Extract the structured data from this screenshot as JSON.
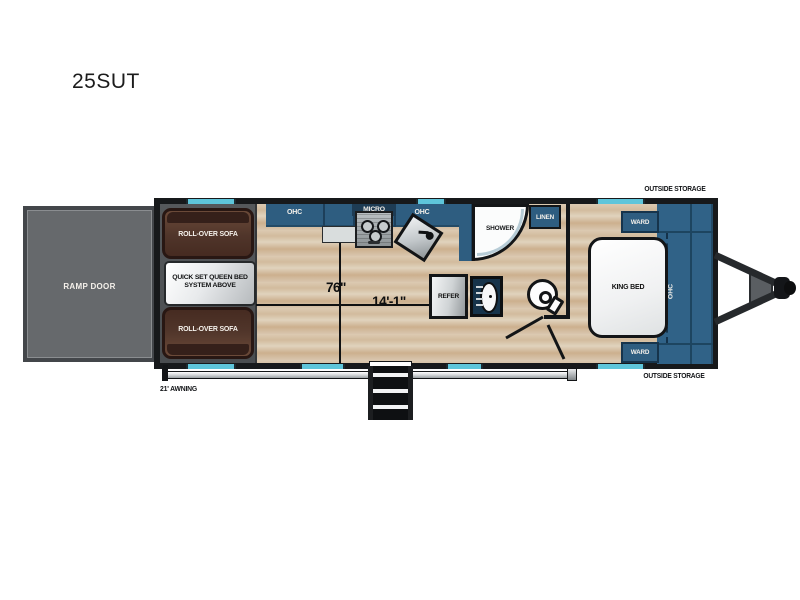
{
  "title": "25SUT",
  "plan": {
    "ramp_door": "RAMP DOOR",
    "garage": {
      "sofa_top": "ROLL-OVER SOFA",
      "queen_bed": "QUICK SET QUEEN BED SYSTEM ABOVE",
      "sofa_bottom": "ROLL-OVER SOFA"
    },
    "kitchen": {
      "ohc_left": "OHC",
      "micro": "MICRO",
      "ohc_right": "OHC"
    },
    "bath": {
      "shower": "SHOWER",
      "linen": "LINEN",
      "refer": "REFER"
    },
    "bedroom": {
      "king_bed": "KING BED",
      "ward_top": "WARD",
      "ward_bottom": "WARD",
      "ohc": "OHC"
    },
    "exterior": {
      "outside_storage_top": "OUTSIDE STORAGE",
      "outside_storage_bottom": "OUTSIDE STORAGE",
      "awning": "21' AWNING"
    },
    "dimensions": {
      "garage_width": "76\"",
      "garage_length": "14'-1\""
    }
  },
  "colors": {
    "cabinet_blue": "#2e5d80",
    "window_cyan": "#5ec5da",
    "sofa_brown": "#50352a",
    "wall_dark": "#17191b",
    "floor_wood": "#d7c4ac",
    "garage_gray": "#4e5154",
    "ramp_gray": "#66696c"
  }
}
